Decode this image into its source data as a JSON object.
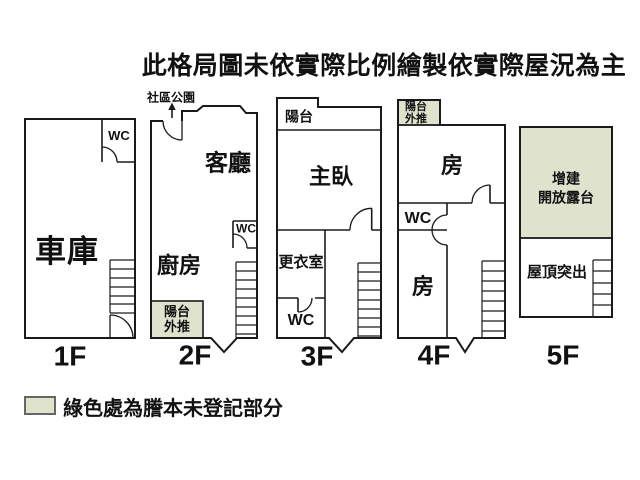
{
  "title": "此格局圖未依實際比例繪製依實際屋況為主",
  "floors": {
    "f1": {
      "name": "1F",
      "garage": "車庫",
      "wc": "WC"
    },
    "f2": {
      "name": "2F",
      "park": "社區公園",
      "living": "客廳",
      "kitchen": "廚房",
      "wc": "WC",
      "balcony_push_1": "陽台",
      "balcony_push_2": "外推"
    },
    "f3": {
      "name": "3F",
      "balcony": "陽台",
      "master": "主臥",
      "dressing": "更衣室",
      "wc": "WC"
    },
    "f4": {
      "name": "4F",
      "balcony_push_1": "陽台",
      "balcony_push_2": "外推",
      "room_top": "房",
      "wc": "WC",
      "room_bottom": "房"
    },
    "f5": {
      "name": "5F",
      "terrace_1": "增建",
      "terrace_2": "開放露台",
      "roof": "屋頂突出"
    }
  },
  "legend": {
    "text": "綠色處為謄本未登記部分"
  },
  "colors": {
    "wall": "#1a1a1a",
    "unregistered_green": "#dfe3cd",
    "background": "#ffffff"
  }
}
